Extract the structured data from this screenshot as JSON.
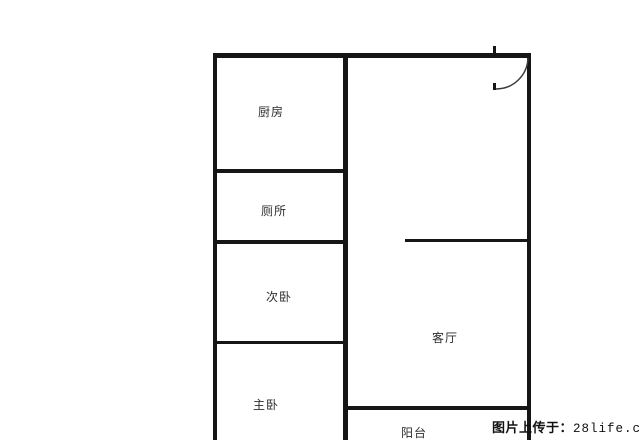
{
  "page": {
    "background_color": "#ffffff",
    "wall_color": "#161616",
    "label_color": "#2d2d2d",
    "watermark_color": "#111111"
  },
  "floorplan": {
    "rooms": [
      {
        "name": "kitchen",
        "label": "厨房"
      },
      {
        "name": "toilet",
        "label": "厕所"
      },
      {
        "name": "second-bedroom",
        "label": "次卧"
      },
      {
        "name": "master-bedroom",
        "label": "主卧"
      },
      {
        "name": "living-room",
        "label": "客厅"
      },
      {
        "name": "balcony",
        "label": "阳台"
      }
    ],
    "door": {
      "name": "entry-door"
    }
  },
  "watermark": {
    "prefix": "图片上传于：",
    "site": "28life.com"
  }
}
